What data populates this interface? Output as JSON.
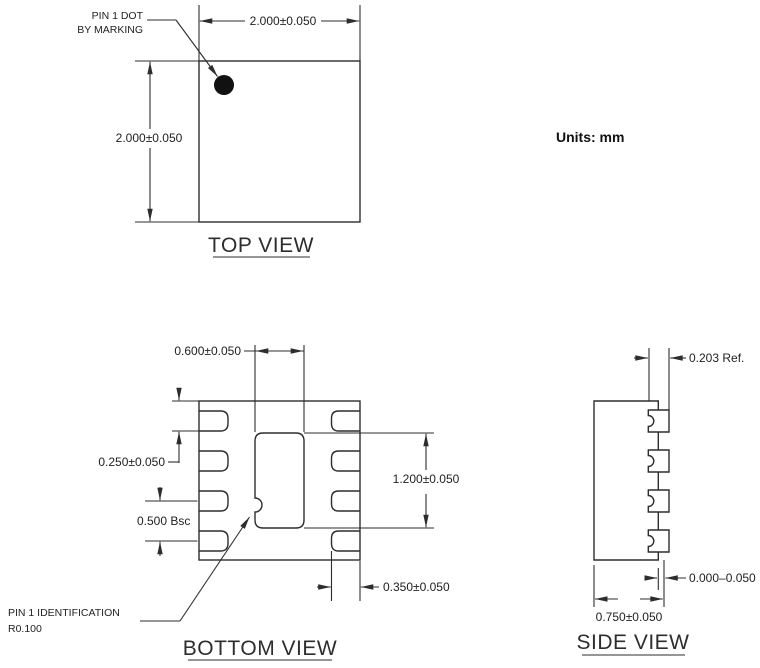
{
  "units_label": "Units: mm",
  "top_view": {
    "title": "TOP VIEW",
    "pin1_note_line1": "PIN 1 DOT",
    "pin1_note_line2": "BY MARKING",
    "dim_width": "2.000±0.050",
    "dim_height": "2.000±0.050"
  },
  "bottom_view": {
    "title": "BOTTOM VIEW",
    "dim_pad_width": "0.600±0.050",
    "dim_pin_edge": "0.250±0.050",
    "dim_pitch": "0.500 Bsc",
    "dim_pad_height": "1.200±0.050",
    "dim_pin_length": "0.350±0.050",
    "pin1_note_line1": "PIN 1 IDENTIFICATION",
    "pin1_note_line2": "R0.100"
  },
  "side_view": {
    "title": "SIDE VIEW",
    "dim_terminal_width": "0.203 Ref.",
    "dim_standoff": "0.000–0.050",
    "dim_thickness": "0.750±0.050"
  },
  "colors": {
    "line": "#2d2d2d",
    "text": "#222222",
    "background": "#ffffff"
  }
}
